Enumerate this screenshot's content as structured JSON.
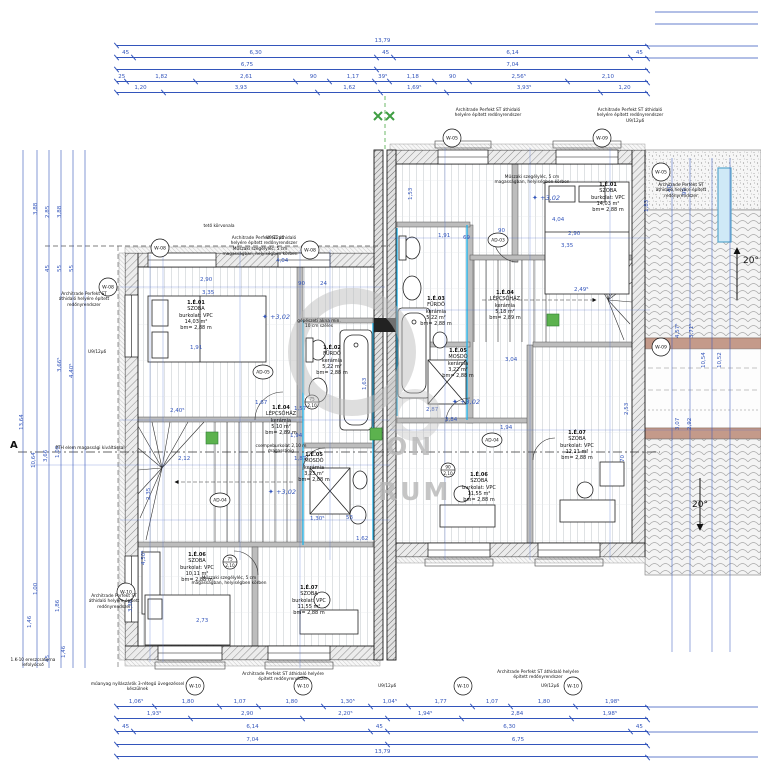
{
  "drawing": {
    "type": "emeleti alaprajz / floor plan"
  },
  "dims": {
    "top": {
      "total": [
        "13,79"
      ],
      "row2": [
        "45",
        "6,30",
        "45",
        "6,14",
        "45"
      ],
      "row3": [
        "6,75",
        "7,04"
      ],
      "row4": [
        "25",
        "1,82",
        "2,61",
        "90",
        "1,17",
        "39⁵",
        "1,18",
        "90",
        "2,56⁵",
        "2,10"
      ],
      "row5": [
        "1,20",
        "3,93",
        "1,62",
        "1,69⁵",
        "3,93⁵",
        "1,20"
      ]
    },
    "bottom": {
      "row1": [
        "1,06⁵",
        "1,80",
        "1,07",
        "1,80",
        "1,30⁵",
        "1,04⁵",
        "1,77",
        "1,07",
        "1,80",
        "1,98⁵"
      ],
      "row2": [
        "1,93⁵",
        "2,90",
        "2,20⁵",
        "1,94⁵",
        "2,84",
        "1,98⁵"
      ],
      "row3": [
        "45",
        "6,14",
        "45",
        "6,30",
        "45"
      ],
      "row4": [
        "7,04",
        "6,75"
      ],
      "total": [
        "13,79"
      ]
    },
    "left": [
      "3,88",
      "2,85",
      "3,88",
      "45",
      "55",
      "55",
      "3,66⁵",
      "4,40⁵",
      "13,64",
      "10,64",
      "3,66",
      "1,00",
      "1,00",
      "1,86",
      "1,46",
      "45",
      "1,46"
    ],
    "roof": [
      "40",
      "90",
      "4,57⁵",
      "3,71⁵",
      "10,54",
      "10,52",
      "3,07",
      "2,92"
    ],
    "inner": [
      "4,04",
      "2,90",
      "3,35",
      "90",
      "24",
      "1,91",
      "1,67",
      "2,40⁵",
      "1,57",
      "1,94",
      "1,87",
      "2,12",
      "2,73",
      "1,30⁵",
      "4,04",
      "2,90",
      "3,35",
      "90",
      "1,91",
      "69",
      "3,04",
      "2,49⁵",
      "3,84",
      "2,87",
      "1,94",
      "53",
      "1,62"
    ],
    "inner_v": [
      "4,50⁵",
      "3,36",
      "1,53",
      "1,83",
      "2,35",
      "2,53",
      "70",
      "1,63"
    ]
  },
  "rooms": {
    "l1": {
      "id": "1.É.01",
      "name": "SZOBA",
      "finish": "burkolat: VPC",
      "area": "14,03 m²",
      "height": "bm= 2,88 m"
    },
    "l2": {
      "id": "1.É.02",
      "name": "FÜRDŐ",
      "finish": "kerámia",
      "area": "5,22 m²",
      "height": "bm= 2,88 m"
    },
    "l3": {
      "id": "1.É.04",
      "name": "LÉPCSŐHÁZ",
      "finish": "kerámia",
      "area": "5,10 m²",
      "height": "bm= 2,89 m"
    },
    "l4": {
      "id": "1.É.05",
      "name": "MOSDÓ",
      "finish": "kerámia",
      "area": "3,23 m²",
      "height": "bm= 2,88 m"
    },
    "l5": {
      "id": "1.É.06",
      "name": "SZOBA",
      "finish": "burkolat: VPC",
      "area": "10,11 m²",
      "height": "bm= 2,88 m"
    },
    "l6": {
      "id": "1.É.07",
      "name": "SZOBA",
      "finish": "burkolat: VPC",
      "area": "11,55 m²",
      "height": "bm= 2,88 m"
    },
    "r1": {
      "id": "1.É.01",
      "name": "SZOBA",
      "finish": "burkolat: VPC",
      "area": "14,03 m²",
      "height": "bm= 2,88 m"
    },
    "r2": {
      "id": "1.É.03",
      "name": "FÜRDŐ",
      "finish": "kerámia",
      "area": "5,22 m²",
      "height": "bm= 2,88 m"
    },
    "r3": {
      "id": "1.É.04",
      "name": "LÉPCSŐHÁZ",
      "finish": "kerámia",
      "area": "5,18 m²",
      "height": "bm= 2,89 m"
    },
    "r4": {
      "id": "1.É.05",
      "name": "MOSDÓ",
      "finish": "kerámia",
      "area": "3,22 m²",
      "height": "bm= 2,88 m"
    },
    "r5": {
      "id": "1.É.06",
      "name": "SZOBA",
      "finish": "burkolat: VPC",
      "area": "11,55 m²",
      "height": "bm= 2,88 m"
    },
    "r6": {
      "id": "1.É.07",
      "name": "SZOBA",
      "finish": "burkolat: VPC",
      "area": "12,11 m²",
      "height": "bm= 2,88 m"
    }
  },
  "annotations": {
    "shutter": "Architrade Perfekt ST áthidaló helyére épített redőnyrendszer",
    "skirting": "Műszaki szegélyléc, 5 cm magasságban, helyiségben körben",
    "roof_outline": "tető körvonala",
    "tiling": "csempeburkolat 2,10 m magasságig",
    "shaft": "gépészeti akna min. 10 cm széles",
    "glazing": "műanyag nyílászárók 3-rétegű üvegezéssel készülnek",
    "gutter": "1.K-10 ereszcsatorna lefolyócső",
    "pth": "PTH elem magassági kiváltással",
    "uv": "U9/12μ6"
  },
  "levels": [
    "+3,02",
    "+3,02",
    "+3,02",
    "+3,02"
  ],
  "slope": "20°",
  "section": "A",
  "windows": [
    "W-08",
    "W-08",
    "W-08",
    "W-05",
    "W-09",
    "W-05",
    "W-09",
    "W-10",
    "W-10",
    "W-10",
    "W-10",
    "W-10"
  ],
  "doors": [
    "AD-05",
    "AD-03",
    "AD-04",
    "AD-04"
  ],
  "door_sizes": [
    "75",
    "2,10",
    "90",
    "2,10",
    "75",
    "2,10"
  ],
  "watermark": {
    "l1": "ON",
    "l2": "RUM"
  },
  "colors": {
    "dim_blue": "#3355bb",
    "wall": "#8a8a8a",
    "bath_cyan": "#2ab5e8",
    "green": "#4aa23c",
    "band_brown": "#c49a8a",
    "watermark": "#cccccc"
  }
}
